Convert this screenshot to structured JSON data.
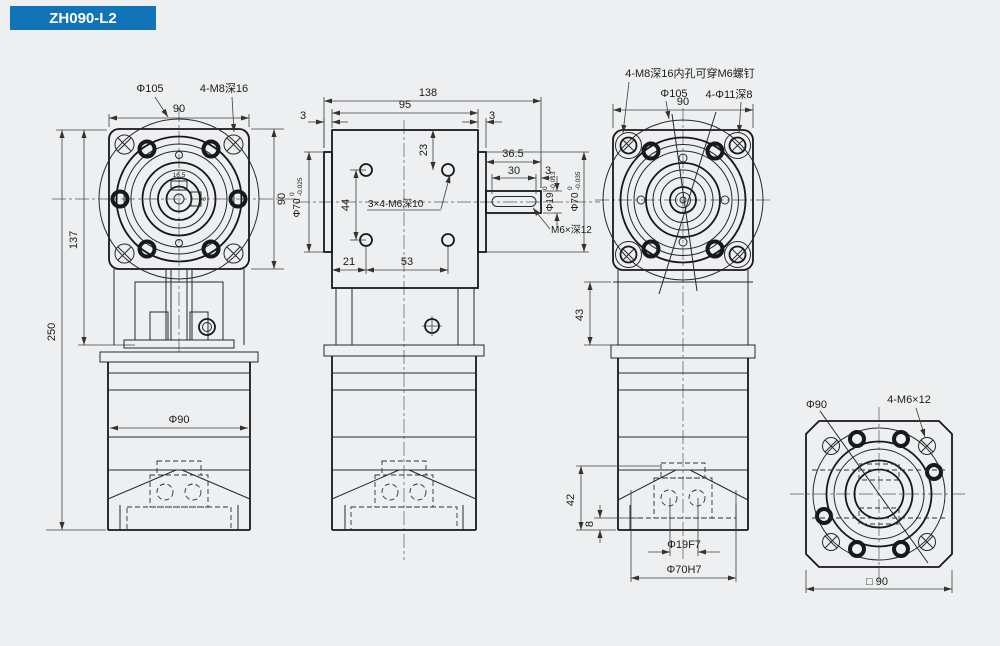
{
  "title": "ZH090-L2",
  "colors": {
    "banner": "#1173b8",
    "background": "#edeff0",
    "line": "#222222"
  },
  "front_view": {
    "dim_flange_circle": "Φ105",
    "dim_bolt_holes": "4-M8深16",
    "dim_width_top": "90",
    "dim_height_right": "90",
    "dim_height_flange_section": "137",
    "dim_height_total": "250",
    "dim_body_diameter": "Φ90",
    "dim_key_width": "16.5",
    "dim_key_height": "6"
  },
  "side_view": {
    "dim_length_total": "138",
    "dim_length_body": "95",
    "dim_plate_left": "3",
    "dim_plate_right": "3",
    "dim_hole_top": "23",
    "dim_hole_spacing_v": "44",
    "label_side_holes": "3×4-M6深10",
    "dim_hole_left": "21",
    "dim_hole_spacing_h": "53",
    "dim_shaft_length": "36.5",
    "dim_key_length": "30",
    "dim_key_end": "3",
    "dim_shaft_dia": {
      "nominal": "Φ19",
      "tol_upper": "0",
      "tol_lower": "-0.013"
    },
    "dim_spigot_right": {
      "nominal": "Φ70",
      "tol_upper": "0",
      "tol_lower": "-0.035"
    },
    "dim_spigot_left": {
      "nominal": "Φ70",
      "tol_upper": "0",
      "tol_lower": "-0.025"
    },
    "label_shaft_tap": "M6×深12"
  },
  "rear_view": {
    "label_bolt_holes": "4-M8深16内孔可穿M6螺钉",
    "dim_flange_circle": "Φ105",
    "dim_corner_holes": "4-Φ11深8",
    "dim_width_top": "90",
    "dim_flange_depth": "43",
    "dim_mount_height": "42",
    "dim_step_height": "8",
    "dim_bore": "Φ19F7",
    "dim_recess": "Φ70H7"
  },
  "output_face_view": {
    "dim_circle": "Φ90",
    "dim_screws": "4-M6×12",
    "dim_square": "□ 90"
  }
}
